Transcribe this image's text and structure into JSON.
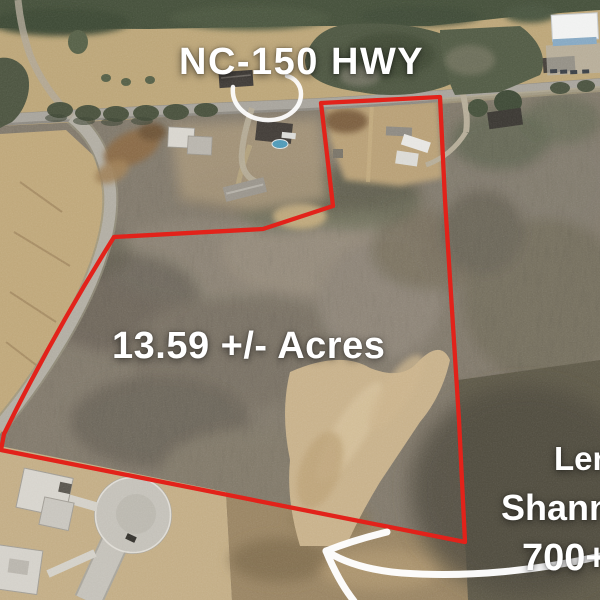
{
  "annotations": {
    "highway_label": "NC-150 HWY",
    "acreage_label": "13.59 +/- Acres",
    "cutoff_line1": "Len",
    "cutoff_line2": "Shanno",
    "cutoff_line3": "700+"
  },
  "colors": {
    "boundary-red": "#e2221a",
    "annotation-white": "#ffffff"
  }
}
